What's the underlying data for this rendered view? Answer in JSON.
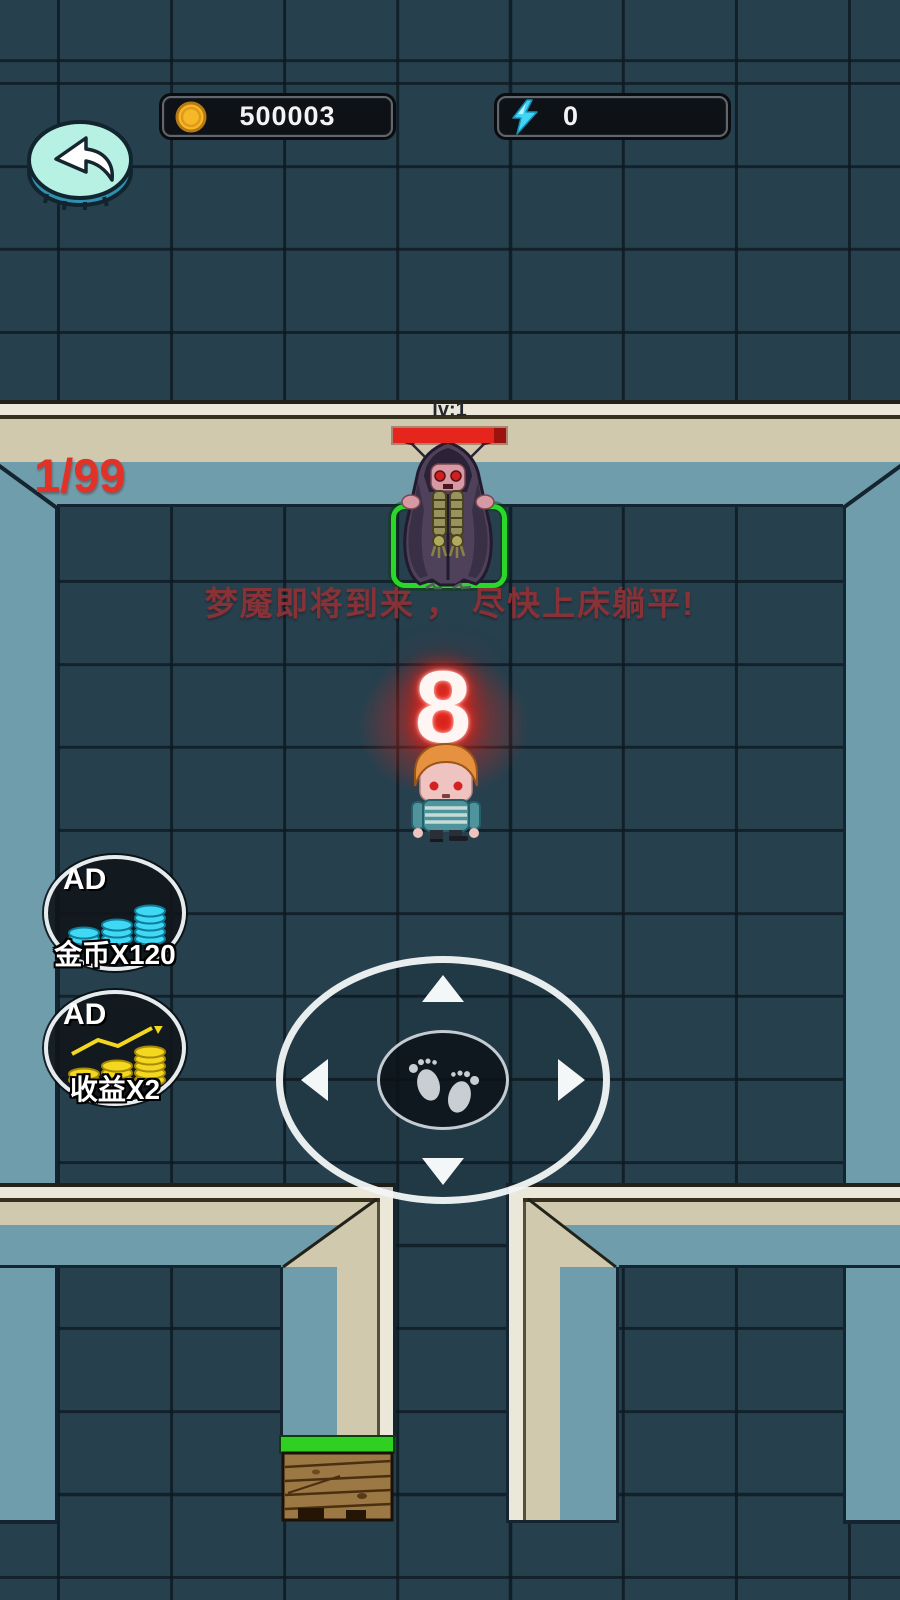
{
  "hud": {
    "coin_counter": {
      "value": "500003"
    },
    "energy_counter": {
      "value": "0"
    }
  },
  "battle": {
    "boss_level": "lv:1",
    "wave": "1/99",
    "warning": "梦魇即将到来 ， 尽快上床躺平!",
    "countdown": "8"
  },
  "ad_buttons": [
    {
      "badge": "AD",
      "label": "金币X120"
    },
    {
      "badge": "AD",
      "label": "收益X2"
    }
  ],
  "colors": {
    "tile": "#26404e",
    "wall_tan": "#d0c9ad",
    "wall_teal": "#709dab",
    "accent_green": "#29d829",
    "hp_red": "#e6251d",
    "coin_gold": "#f6b826",
    "energy_cyan": "#41d4f4"
  }
}
